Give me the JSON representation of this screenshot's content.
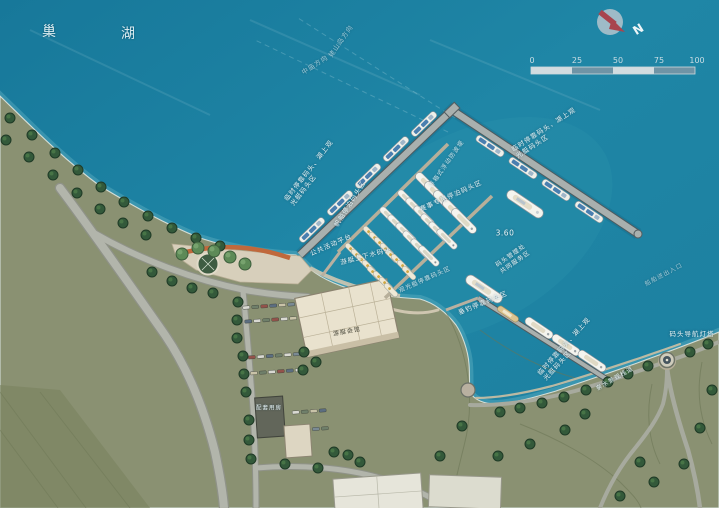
{
  "map_title": {
    "lake_char_1": "巢",
    "lake_char_2": "湖"
  },
  "compass": {
    "north": "N"
  },
  "scale_bar": {
    "ticks": [
      "0",
      "25",
      "50",
      "75",
      "100"
    ]
  },
  "labels": {
    "dir_laoshan": "姥山岛方向",
    "dir_zhongmiao": "中庙方向",
    "temp_dock_line1": "临时停靠码头、湖上观",
    "temp_dock_line2": "光艇码头区",
    "floating_breakwater": "浮箱式浮动防波堤",
    "sail_area": "帆船停泊码头区",
    "race_area": "赛事专用停泊码头区",
    "public_platform": "公共活动平台",
    "launch_dock": "游艇上下水码头",
    "sightseeing_dock": "观光艇停靠码头区",
    "fishing_dock": "垂钓停靠码头区",
    "water_level": "3.60",
    "harbor_note_line1": "码头管理处",
    "harbor_note_line2": "共同服务区",
    "entrance": "船舶进出入口",
    "waterfront_walk": "亲水景观栈道",
    "lighthouse": "码头导航灯塔",
    "terminal_building": "游艇会馆",
    "support_building": "配套用房"
  },
  "colors": {
    "water": "#1b7e9e",
    "land": "#8a9172",
    "pier": "#a9b0ae",
    "dock": "#b7af9a",
    "tree": "#33593a",
    "boat": "#f4f4ee",
    "boat_stripe": "#4a7fb0",
    "compass_red": "#a8454e",
    "scale_light": "#d2dce0",
    "scale_dark": "#6f94a6"
  }
}
